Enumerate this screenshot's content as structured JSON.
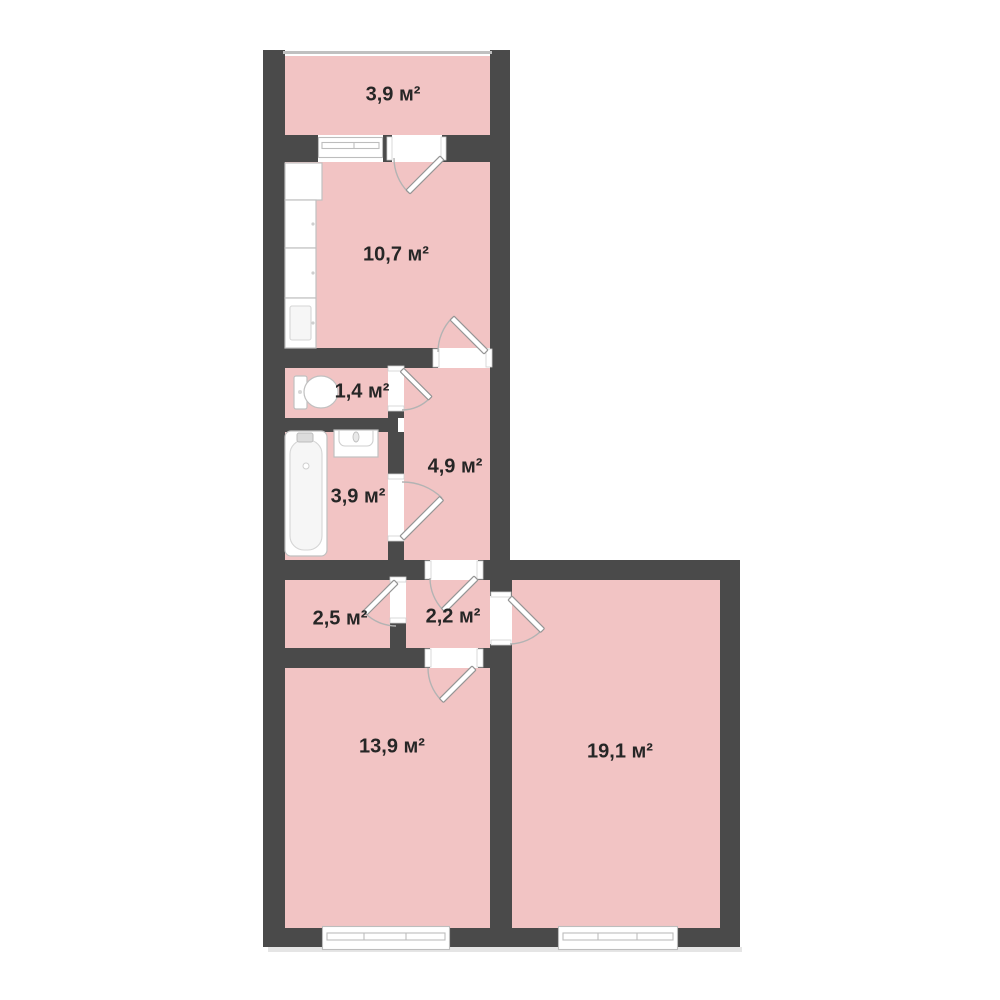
{
  "plan": {
    "area_unit": "м²"
  },
  "colors": {
    "background": "#ffffff",
    "wall": "#4a4a4a",
    "room_fill": "#f2c4c4",
    "fixture_stroke": "#c0c0c0",
    "door_arc": "#b3b3b3",
    "label_text": "#262626",
    "balcony_rail": "#c0c0c0"
  },
  "rooms": [
    {
      "id": "balcony",
      "label": "3,9 м²"
    },
    {
      "id": "kitchen",
      "label": "10,7 м²"
    },
    {
      "id": "wc",
      "label": "1,4 м²"
    },
    {
      "id": "hallway",
      "label": "4,9 м²"
    },
    {
      "id": "bathroom",
      "label": "3,9 м²"
    },
    {
      "id": "storage",
      "label": "2,5 м²"
    },
    {
      "id": "inner-hall",
      "label": "2,2 м²"
    },
    {
      "id": "bedroom",
      "label": "13,9 м²"
    },
    {
      "id": "living-room",
      "label": "19,1 м²"
    }
  ],
  "icons": [
    "bathtub-icon",
    "bathroom-sink-icon",
    "toilet-icon",
    "kitchen-cabinets-icon",
    "window-icon",
    "door-leaf-icon",
    "balcony-railing-icon"
  ]
}
